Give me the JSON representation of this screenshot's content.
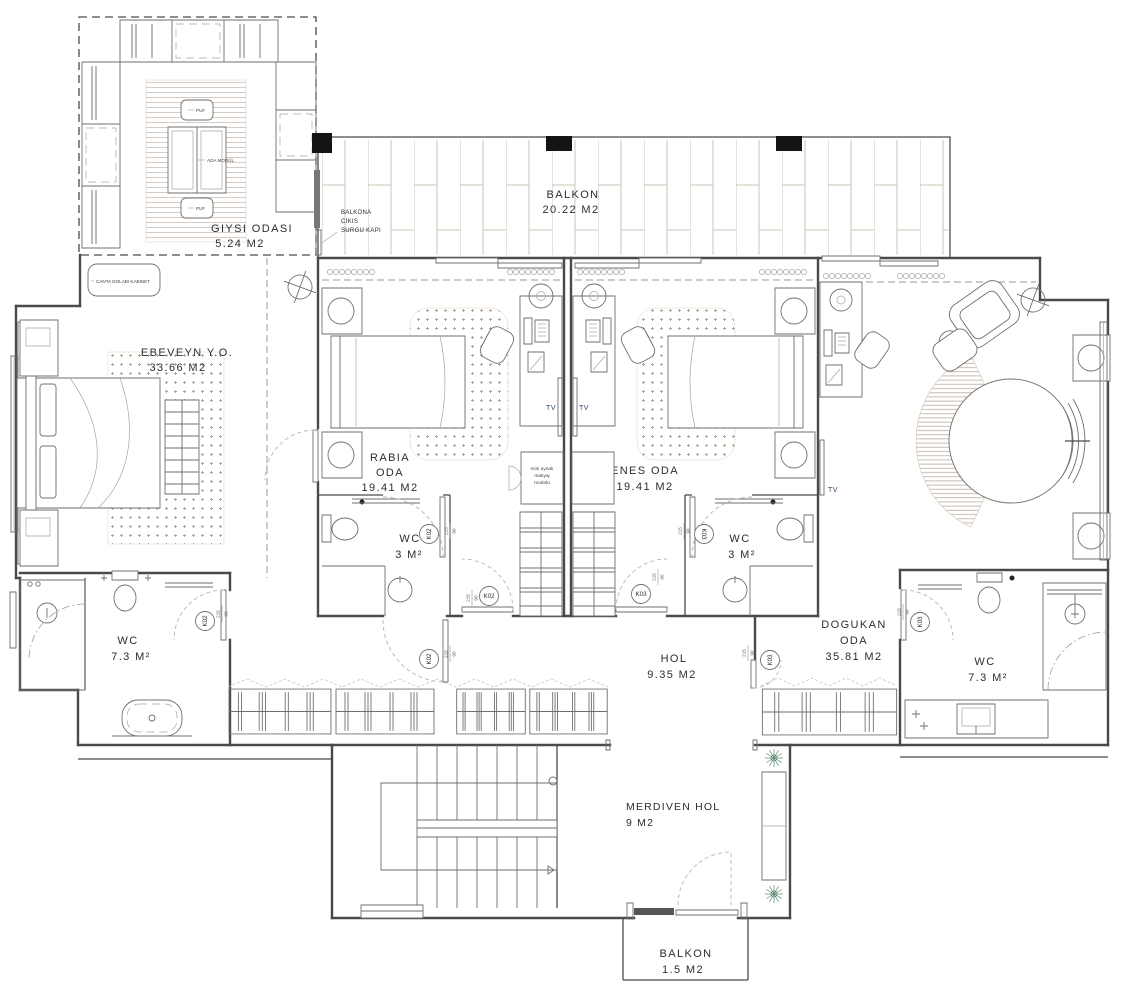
{
  "drawing": {
    "type": "residential floor plan"
  },
  "colors": {
    "wall": "#4a4a4a",
    "furniture": "#6f6f6f",
    "light_line": "#a5a5a5",
    "rug_tan": "#b3a08e",
    "tile_tan": "#cdc3b6",
    "plant_green": "#5c8a73",
    "tv_blue": "#2d4470",
    "column_black": "#141414"
  },
  "rooms": {
    "giysi": {
      "name": "GIYSI ODASI",
      "area": "5.24 M2"
    },
    "balkon_top": {
      "name": "BALKON",
      "area": "20.22 M2"
    },
    "ebeveyn": {
      "name": "EBEVEYN Y.O.",
      "area": "33.66 M2"
    },
    "rabia": {
      "name_line1": "RABIA",
      "name_line2": "ODA",
      "area": "19.41 M2"
    },
    "enes": {
      "name": "ENES ODA",
      "area": "19.41 M2"
    },
    "wc_rabia": {
      "name": "WC",
      "area": "3 M²"
    },
    "wc_enes": {
      "name": "WC",
      "area": "3 M²"
    },
    "wc_left": {
      "name": "WC",
      "area": "7.3 M²"
    },
    "wc_right": {
      "name": "WC",
      "area": "7.3 M²"
    },
    "dogukan": {
      "name_line1": "DOGUKAN",
      "name_line2": "ODA",
      "area": "35.81 M2"
    },
    "hol": {
      "name": "HOL",
      "area": "9.35 M2"
    },
    "merdiven_hol": {
      "name": "MERDIVEN HOL",
      "area": "9 M2"
    },
    "balkon_bottom": {
      "name": "BALKON",
      "area": "1.5 M2"
    }
  },
  "annotations": {
    "balcony_door_note": {
      "line1": "BALKONA",
      "line2": "CIKIS",
      "line3": "SURGU KAPI"
    },
    "bag_cabinet": "CANTA DOLABI KABINET",
    "island_module": "ADA MODÜL",
    "pouf": "PUF",
    "makeup_module": {
      "line1": "mini aynalı",
      "line2": "makyaj",
      "line3": "modülü"
    },
    "tv": "TV"
  },
  "door_marks": {
    "k02": "K02",
    "k03": "K03",
    "width": "90",
    "height": "215"
  }
}
